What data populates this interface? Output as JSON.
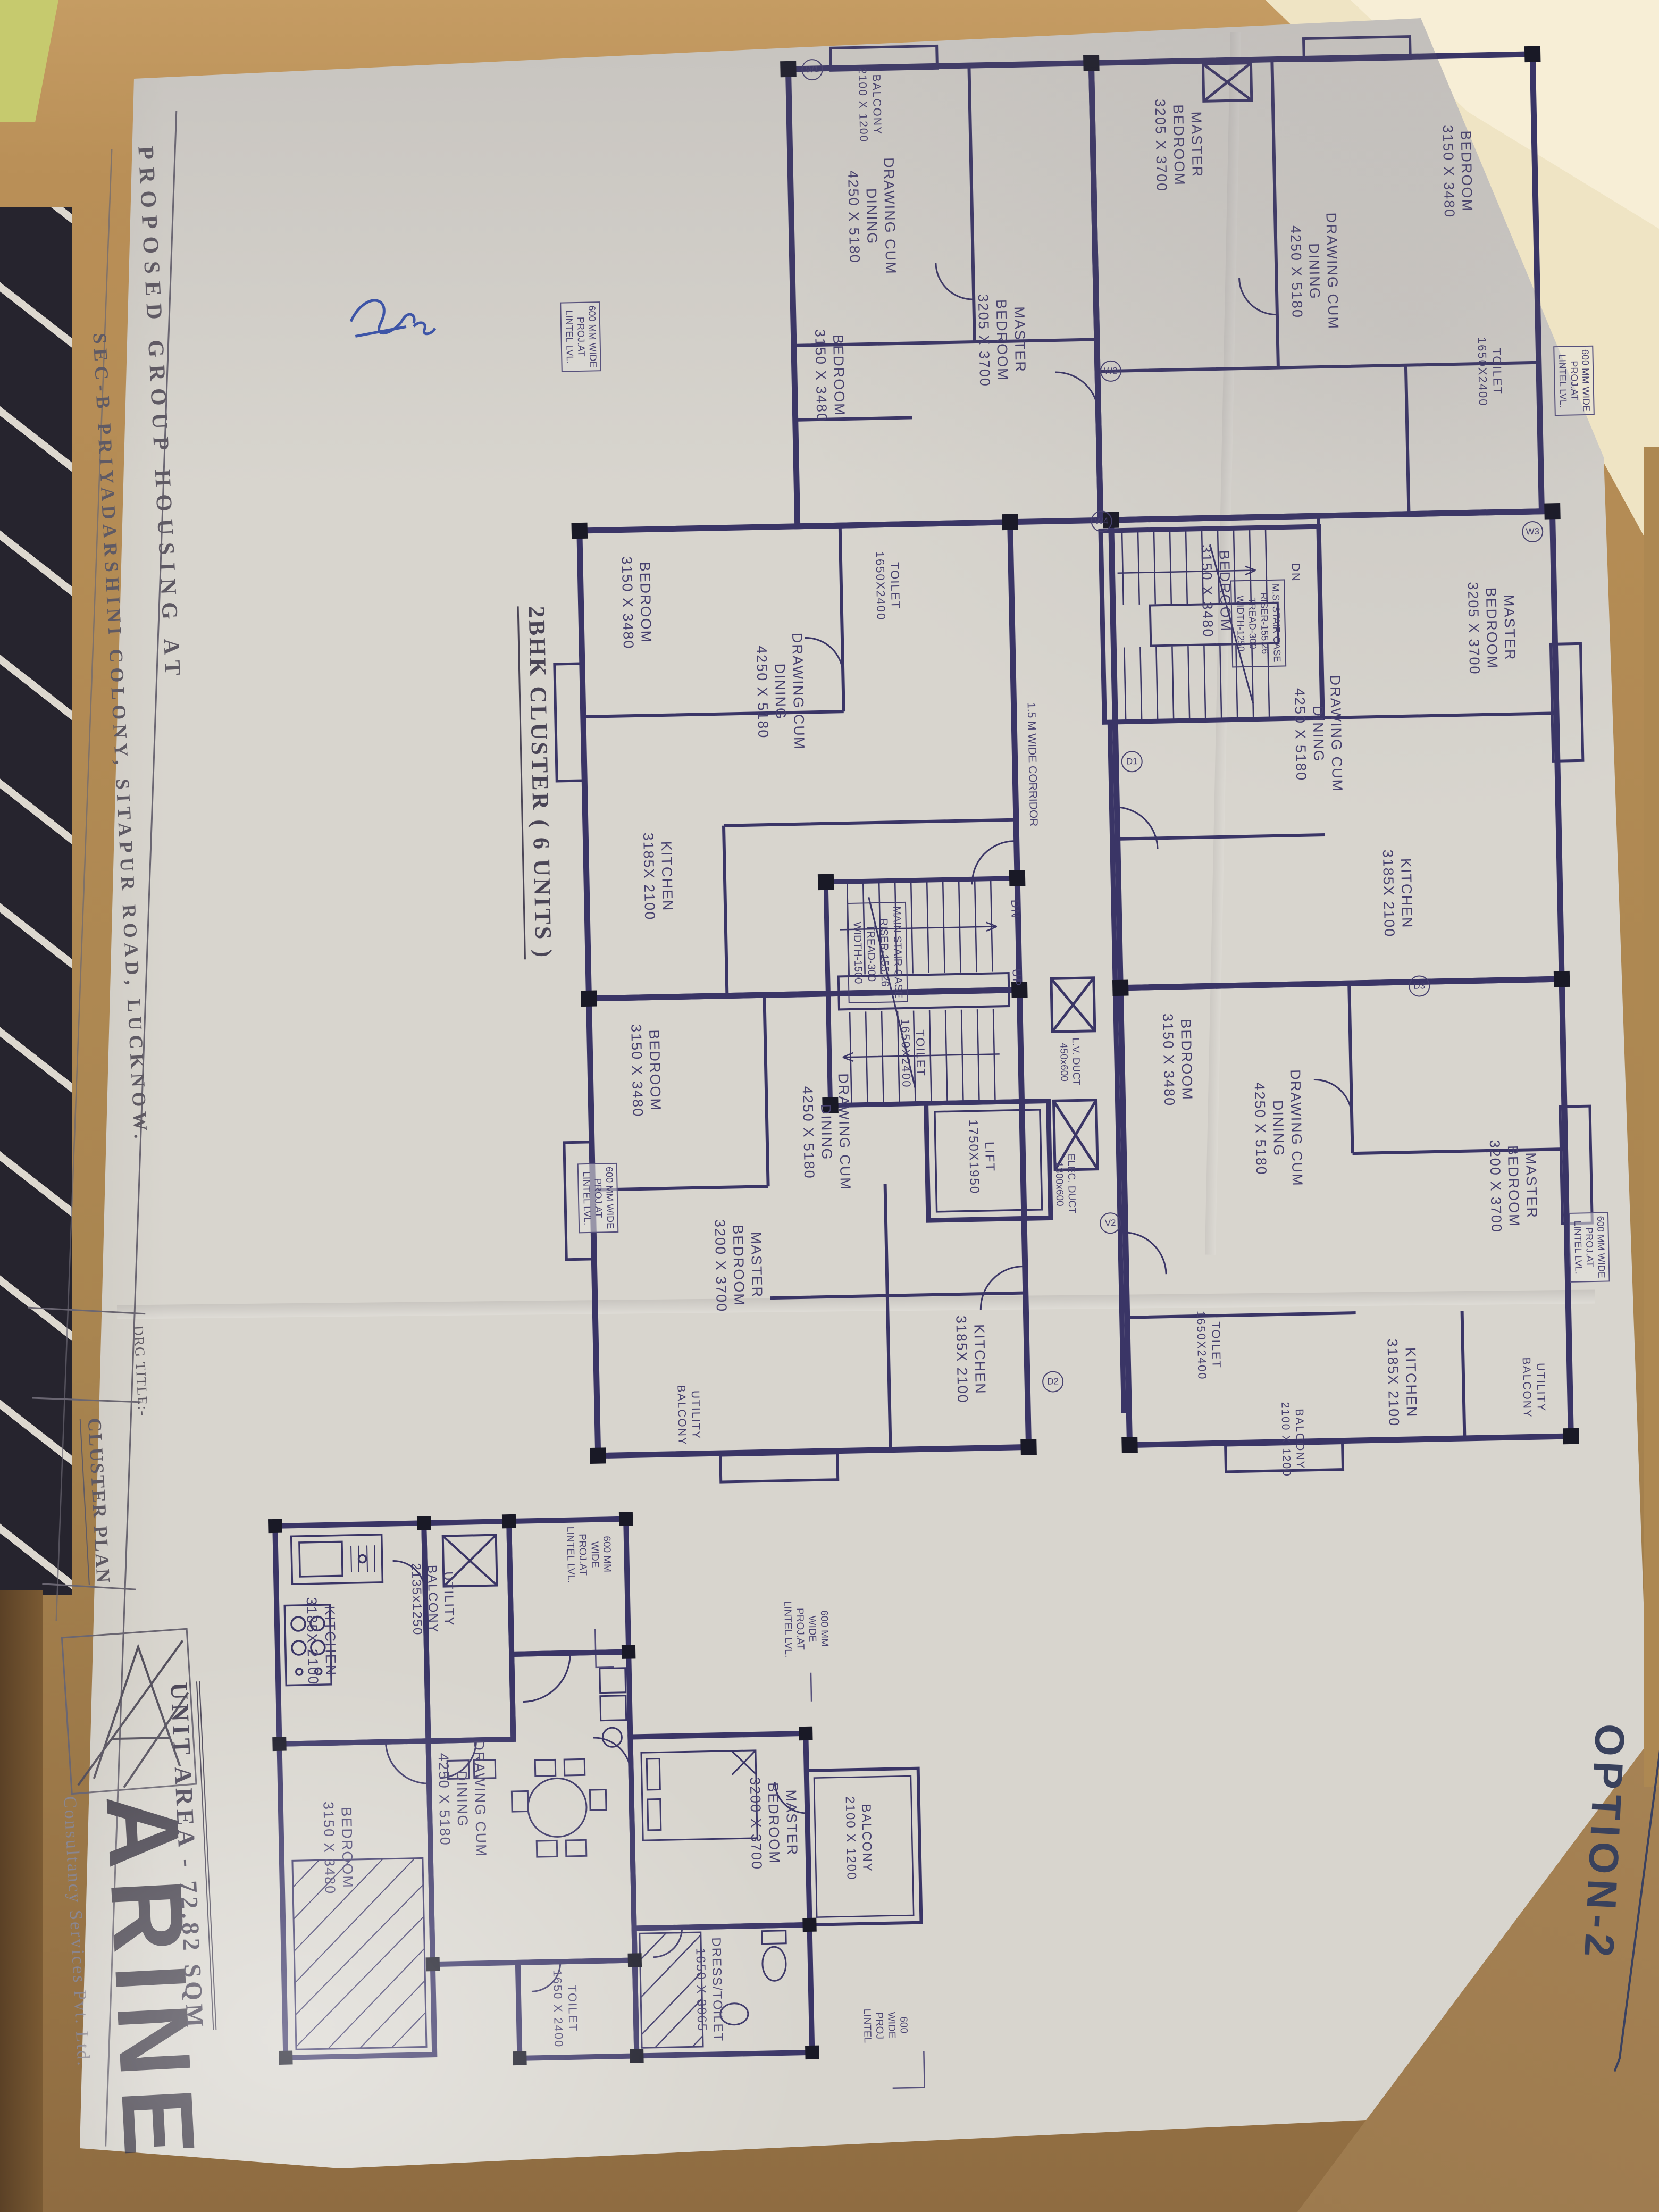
{
  "sheet": {
    "option_label": "OPTION-2",
    "project_title_line1": "PROPOSED GROUP HOUSING AT",
    "project_title_line2": "SEC-B PRIYADARSHINI COLONY, SITAPUR ROAD, LUCKNOW.",
    "drg_title_label": "DRG TITLE:-",
    "drg_title_value": "CLUSTER PLAN",
    "logo_letter": "A",
    "firm_name": "ARINE",
    "firm_subtitle": "Consultancy Services Pvt. Ltd."
  },
  "cluster_plan": {
    "title": "2BHK CLUSTER ( 6 UNITS )",
    "corridor_label": "1.5 M WIDE CORRIDOR",
    "main_staircase_label": "MAIN STAIR CASE\nRISER-155.26\nTREAD-300\nWIDTH-1500",
    "fire_staircase_label": "M.S. STAIR CASE\nRISER-155.26\nTREAD-300\nWIDTH-1250",
    "lift_label": "LIFT\n1750X1950",
    "lv_duct_label": "L.V. DUCT\n450x600",
    "elec_duct_label": "ELEC. DUCT\n1300x600",
    "up_label": "UP",
    "dn_label": "DN",
    "lintel_note": "600 MM WIDE\nPROJ.AT\nLINTEL LVL.",
    "room_labels": [
      "DRAWING CUM\nDINING\n4250 X 5180",
      "MASTER\nBEDROOM\n3205 X 3700",
      "BEDROOM\n3150 X 3480",
      "MASTER\nBEDROOM\n3205 X 3700",
      "DRAWING CUM\nDINING\n4250 X 5180",
      "BEDROOM\n3150 X 3480",
      "TOILET\n1650X2400",
      "BEDROOM\n3150 X 3480",
      "DRAWING CUM\nDINING\n4250 X 5180",
      "KITCHEN\n3185X 2100",
      "TOILET\n1650X2400",
      "BEDROOM\n3150 X 3480",
      "DRAWING CUM\nDINING\n4250 X 5180",
      "MASTER\nBEDROOM\n3205 X 3700",
      "KITCHEN\n3185X 2100",
      "MASTER\nBEDROOM\n3200 X 3700",
      "DRAWING CUM\nDINING\n4250 X 5180",
      "KITCHEN\n3185X 2100",
      "UTILITY\nBALCONY",
      "MASTER\nBEDROOM\n3200 X 3700",
      "DRAWING CUM\nDINING\n4250 X 5180",
      "KITCHEN\n3185X 2100",
      "UTILITY\nBALCONY",
      "BEDROOM\n3150 X 3480",
      "BEDROOM\n3150 X 3480",
      "BALCONY\n2100 X 1200",
      "BALCONY\n2100 X 1200",
      "TOILET\n1650X2400",
      "TOILET\n1650X2400"
    ],
    "opening_codes": [
      "W1",
      "W2",
      "W3",
      "W4",
      "D1",
      "D2",
      "D3",
      "V2"
    ]
  },
  "unit_plan": {
    "unit_area_label": "UNIT AREA - 72.82 SQM",
    "rooms": {
      "kitchen": "KITCHEN\n3185X 2100",
      "utility_balcony": "UTILITY\nBALCONY\n2135x1250",
      "drawing_dining": "DRAWING CUM\nDINING\n4250 X 5180",
      "master_bedroom": "MASTER\nBEDROOM\n3200 X 3700",
      "balcony": "BALCONY\n2100 X 1200",
      "dress_toilet": "DRESS/TOILET\n1650 X 3065",
      "toilet": "TOILET\n1650 X 2400",
      "bedroom": "BEDROOM\n3150 X 3480"
    },
    "lintel_note": "600 MM\nWIDE\nPROJ.AT\nLINTEL LVL.",
    "proj_lintel_note": "600\nWIDE\nPROJ\nLINTEL"
  }
}
